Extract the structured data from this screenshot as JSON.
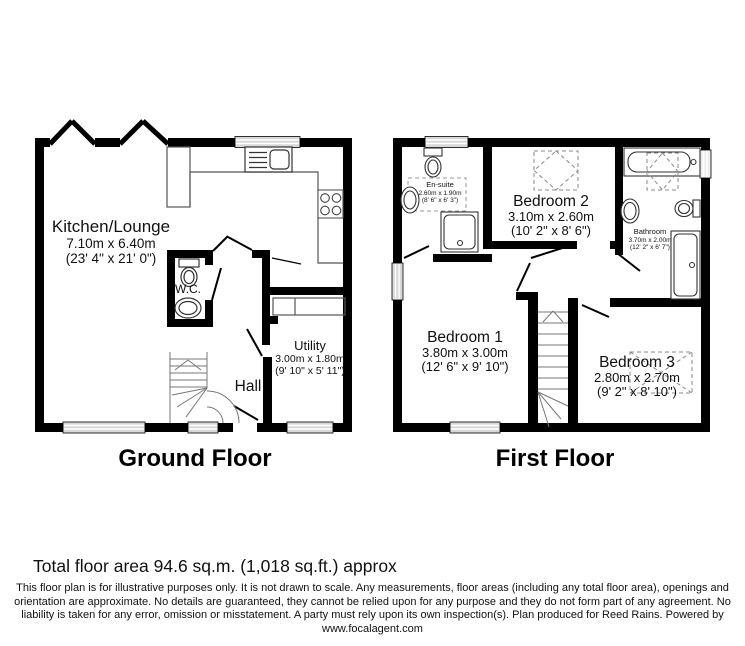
{
  "ground_floor": {
    "title": "Ground Floor",
    "rooms": {
      "kitchen_lounge": {
        "name": "Kitchen/Lounge",
        "dims_m": "7.10m x 6.40m",
        "dims_ft": "(23' 4\" x 21' 0\")"
      },
      "wc": {
        "name": "W.C."
      },
      "utility": {
        "name": "Utility",
        "dims_m": "3.00m x 1.80m",
        "dims_ft": "(9' 10\" x 5' 11\")"
      },
      "hall": {
        "name": "Hall"
      }
    }
  },
  "first_floor": {
    "title": "First Floor",
    "rooms": {
      "bedroom1": {
        "name": "Bedroom 1",
        "dims_m": "3.80m x 3.00m",
        "dims_ft": "(12' 6\" x 9' 10\")"
      },
      "bedroom2": {
        "name": "Bedroom 2",
        "dims_m": "3.10m x 2.60m",
        "dims_ft": "(10' 2\" x 8' 6\")"
      },
      "bedroom3": {
        "name": "Bedroom 3",
        "dims_m": "2.80m x 2.70m",
        "dims_ft": "(9' 2\" x 8' 10\")"
      },
      "ensuite": {
        "name": "En-suite",
        "dims_m": "2.60m x 1.90m",
        "dims_ft": "(8' 6\" x 6' 3\")"
      },
      "bathroom": {
        "name": "Bathroom",
        "dims_m": "3.70m x 2.00m",
        "dims_ft": "(12' 2\" x 6' 7\")"
      }
    }
  },
  "footer": {
    "total_area": "Total floor area 94.6 sq.m. (1,018 sq.ft.) approx",
    "disclaimer_line1": "This floor plan is for illustrative purposes only. It is not drawn to scale. Any measurements, floor areas (including any total floor area), openings and",
    "disclaimer_line2": "orientation are approximate. No details are guaranteed, they cannot be relied upon for any purpose and they do not form part of any agreement. No",
    "disclaimer_line3": "liability is taken for any error, omission or misstatement. A party must rely upon its own inspection(s). Plan produced for Reed Rains. Powered by",
    "disclaimer_line4": "www.focalagent.com"
  },
  "colors": {
    "wall": "#000000",
    "background": "#ffffff",
    "fixture": "#333333"
  }
}
